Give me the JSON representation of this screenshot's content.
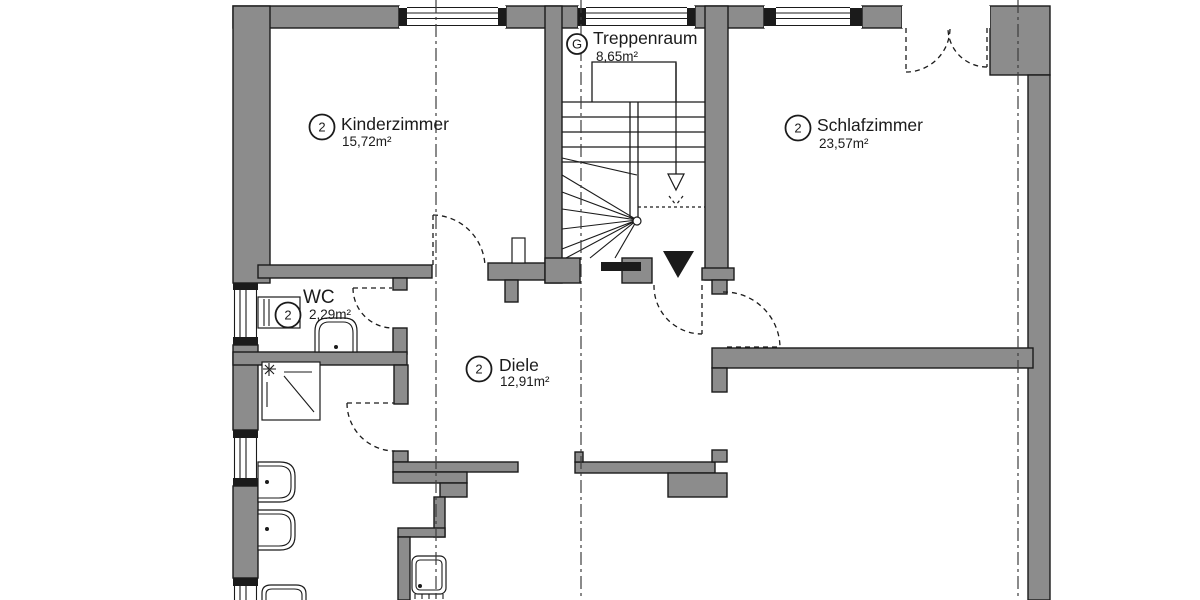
{
  "plan": {
    "colors": {
      "wall_fill": "#8c8c8c",
      "line": "#1b1b1b",
      "axis": "#3c3c3c",
      "background": "#ffffff"
    },
    "rooms": [
      {
        "badge": "G",
        "name": "Treppenraum",
        "area": "8,65m²"
      },
      {
        "badge": "2",
        "name": "Kinderzimmer",
        "area": "15,72m²"
      },
      {
        "badge": "2",
        "name": "Schlafzimmer",
        "area": "23,57m²"
      },
      {
        "badge": "2",
        "name": "WC",
        "area": "2,29m²"
      },
      {
        "badge": "2",
        "name": "Diele",
        "area": "12,91m²"
      }
    ]
  }
}
